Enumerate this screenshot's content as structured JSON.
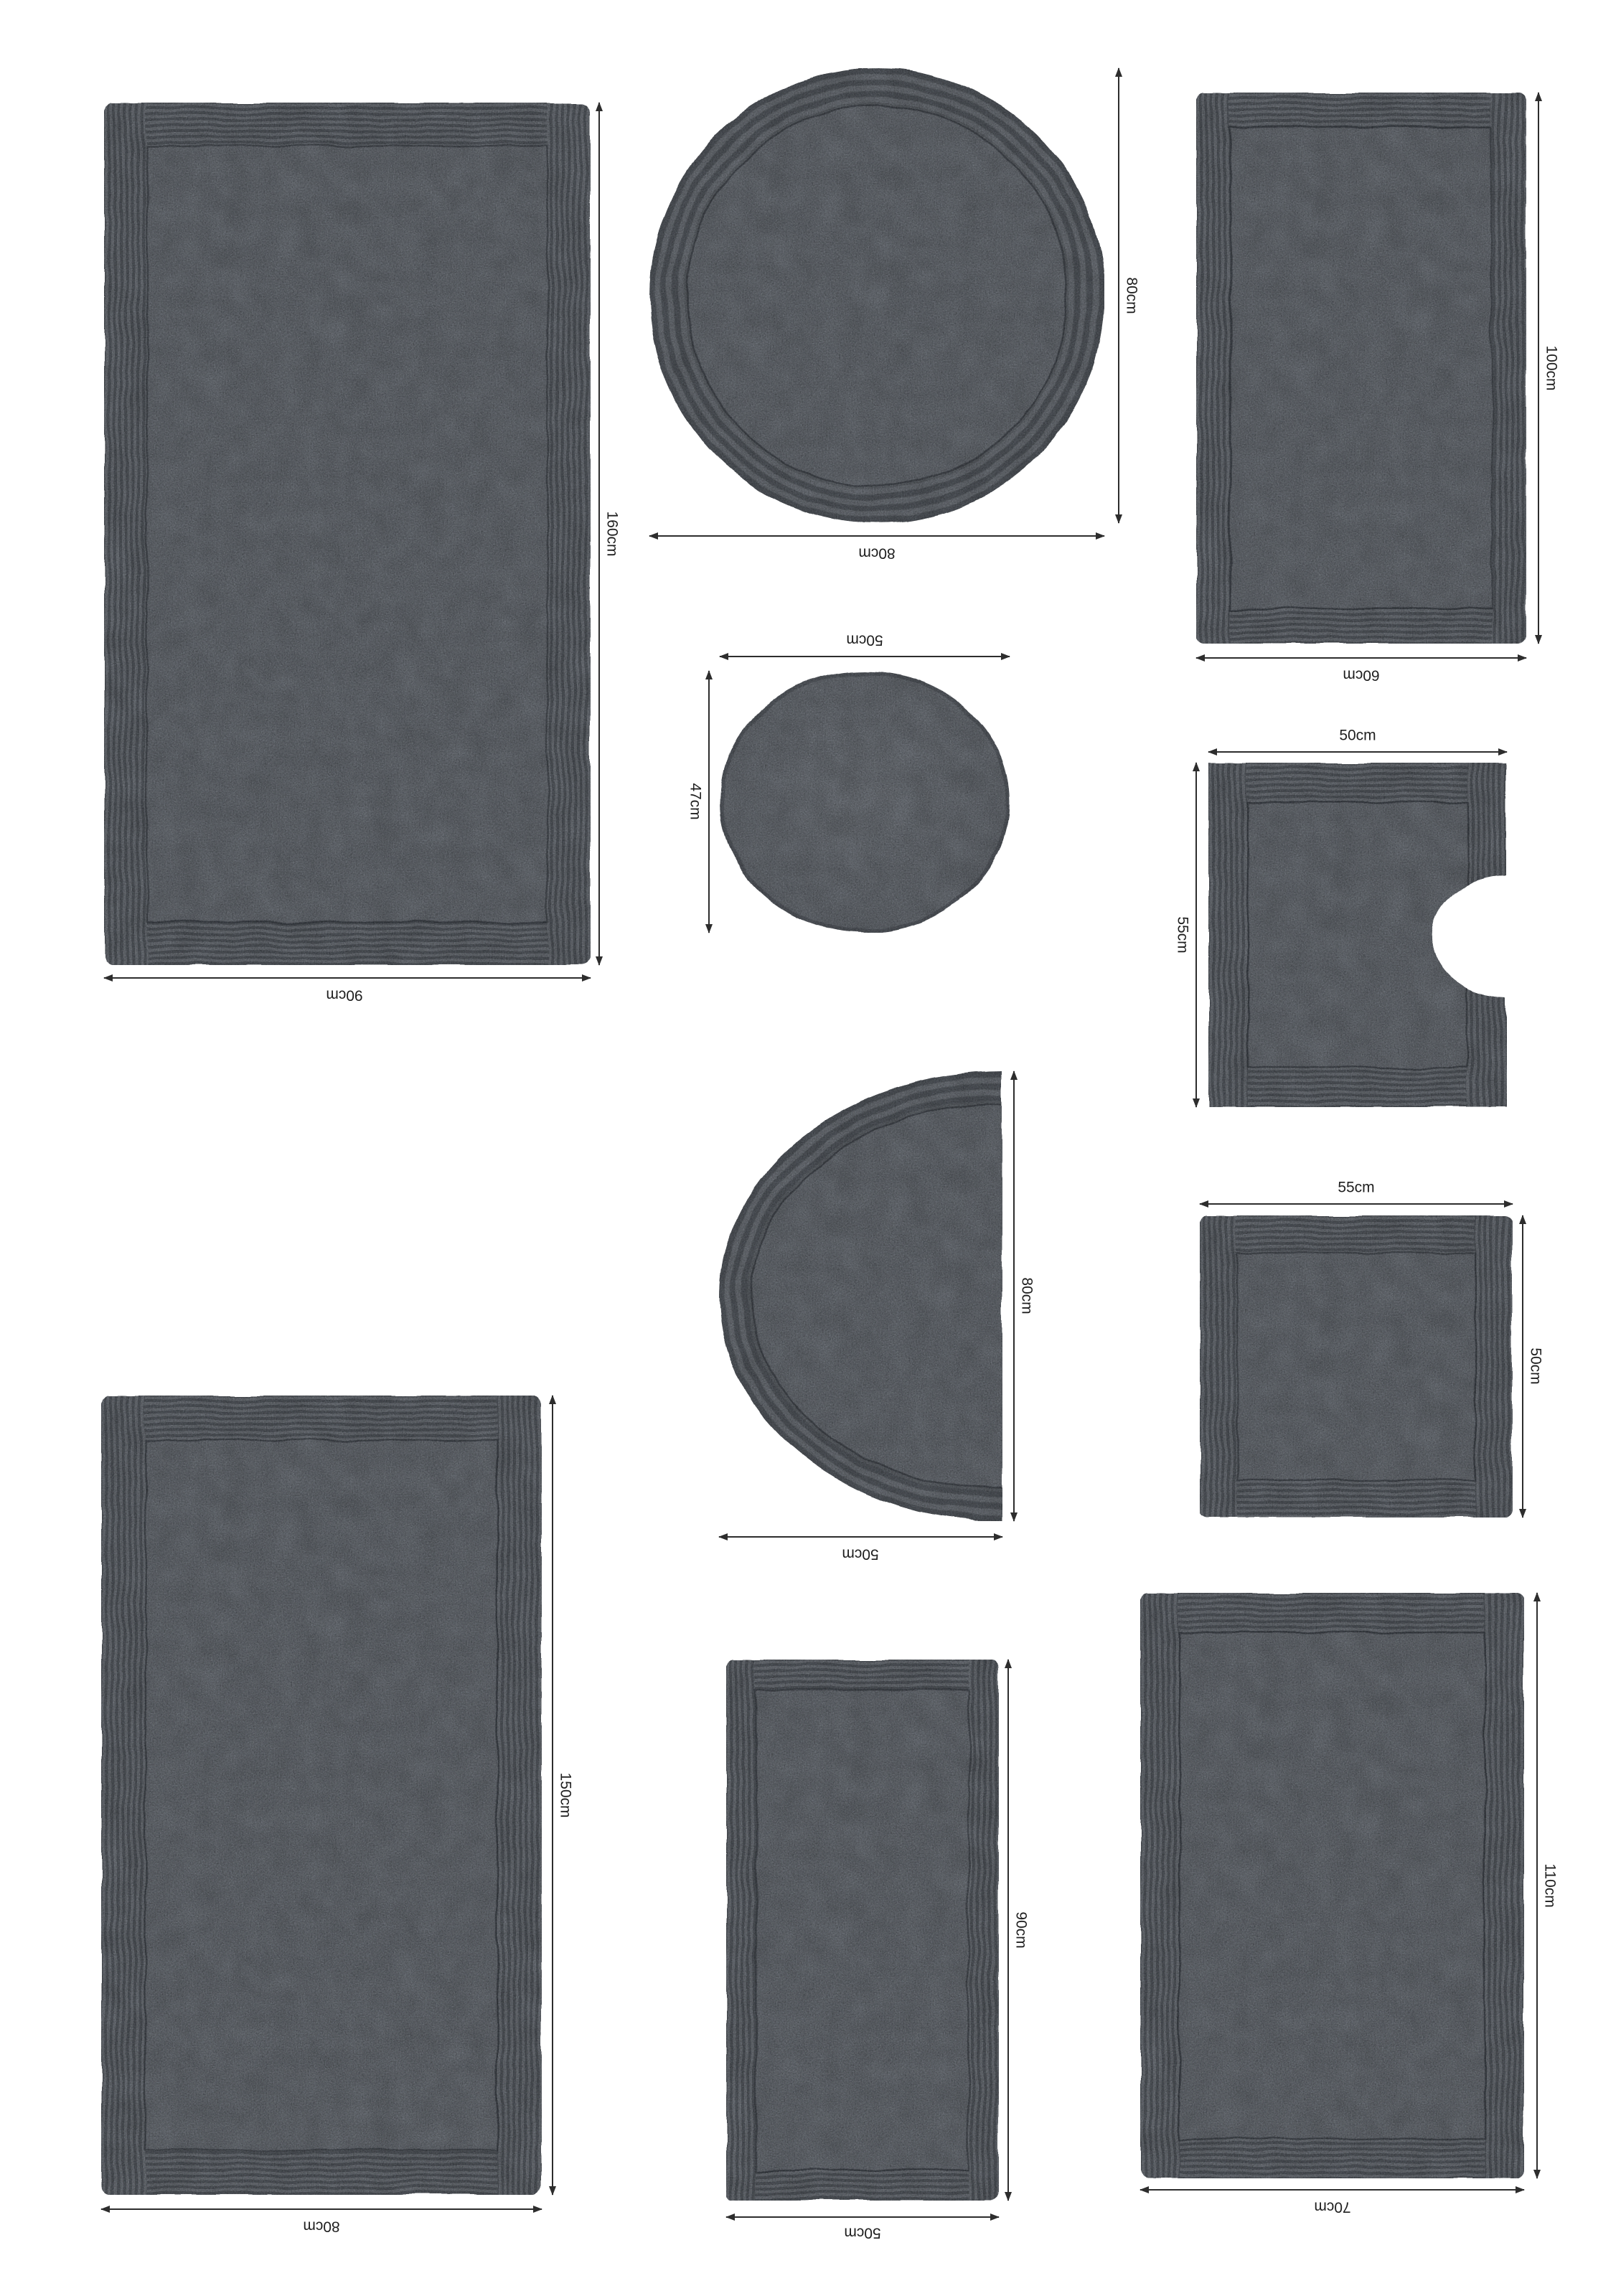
{
  "page": {
    "background": "#ffffff"
  },
  "palette": {
    "mat_border": "#5b6066",
    "mat_field": "#676c73",
    "rib_dark": "#4f545b",
    "rib_light": "#6a6f76",
    "dimension_line": "#2d2d2d",
    "label_text": "#1f1f1f"
  },
  "mats": [
    {
      "name": "rectangular-rug-90x160",
      "shape": "rectangle",
      "w_label": "90cm",
      "h_label": "160cm"
    },
    {
      "name": "round-rug-80",
      "shape": "circle",
      "w_label": "80cm",
      "h_label": "80cm"
    },
    {
      "name": "rectangular-rug-60x100",
      "shape": "rectangle",
      "w_label": "60cm",
      "h_label": "100cm"
    },
    {
      "name": "oval-lid-cover-50x47",
      "shape": "oval",
      "w_label": "50cm",
      "h_label": "47cm"
    },
    {
      "name": "pedestal-mat-50x55",
      "shape": "pedestal",
      "w_label": "50cm",
      "h_label": "55cm"
    },
    {
      "name": "square-mat-55x50",
      "shape": "square",
      "w_label": "55cm",
      "h_label": "50cm"
    },
    {
      "name": "half-moon-rug-50x80",
      "shape": "half-circle",
      "w_label": "50cm",
      "h_label": "80cm"
    },
    {
      "name": "rectangular-rug-80x150",
      "shape": "rectangle",
      "w_label": "80cm",
      "h_label": "150cm"
    },
    {
      "name": "rectangular-rug-50x90",
      "shape": "rectangle",
      "w_label": "50cm",
      "h_label": "90cm"
    },
    {
      "name": "rectangular-rug-70x110",
      "shape": "rectangle",
      "w_label": "70cm",
      "h_label": "110cm"
    }
  ]
}
